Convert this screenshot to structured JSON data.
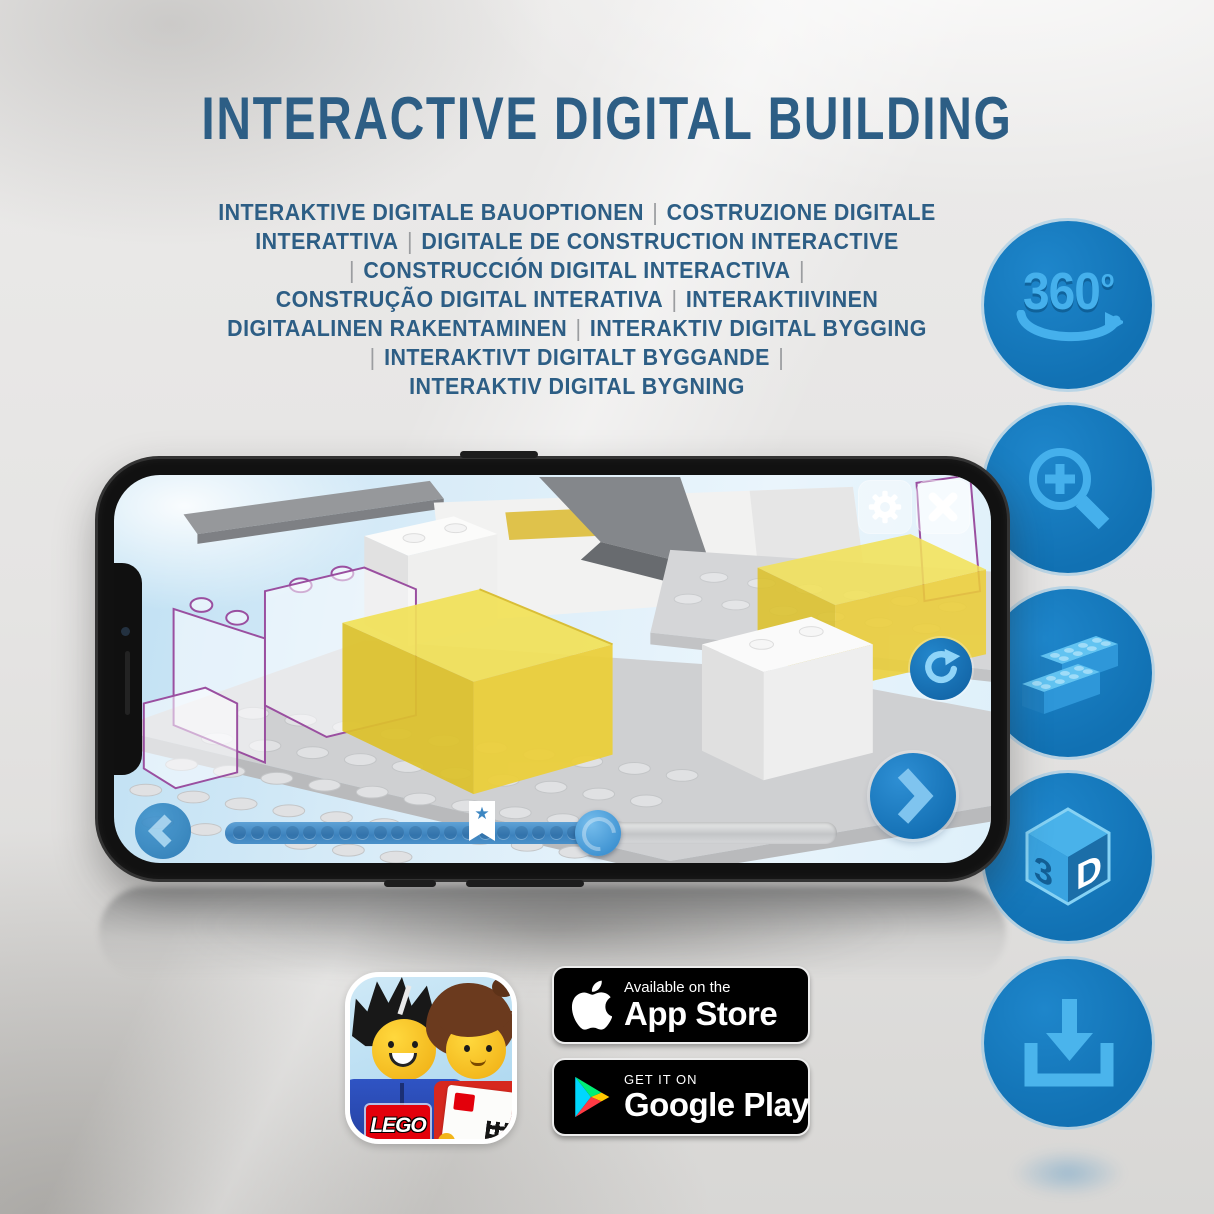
{
  "header": {
    "title": "INTERACTIVE DIGITAL BUILDING"
  },
  "subtitle": {
    "lines": [
      "INTERAKTIVE DIGITALE BAUOPTIONEN | COSTRUZIONE DIGITALE",
      "INTERATTIVA | DIGITALE DE CONSTRUCTION INTERACTIVE",
      "| CONSTRUCCIÓN DIGITAL INTERACTIVA |",
      "CONSTRUÇÃO DIGITAL INTERATIVA | INTERAKTIIVINEN",
      "DIGITAALINEN RAKENTAMINEN | INTERAKTIV DIGITAL BYGGING",
      "| INTERAKTIVT DIGITALT BYGGANDE |",
      "INTERAKTIV DIGITAL BYGNING"
    ]
  },
  "features": {
    "rotate360": {
      "number": "360",
      "degree": "o"
    },
    "cube": {
      "left": "3",
      "right": "D"
    },
    "icon_names": [
      "360-rotation-icon",
      "zoom-in-icon",
      "lego-brick-icon",
      "3d-view-icon",
      "download-icon"
    ]
  },
  "phone_app": {
    "progress": {
      "percent": 61,
      "bookmark_percent": 42,
      "dots": 20,
      "star": "★"
    },
    "icon_names": [
      "settings-gear-icon",
      "close-icon",
      "rotate-icon",
      "previous-arrow-icon",
      "next-arrow-icon"
    ]
  },
  "store": {
    "app_store": {
      "line1": "Available on the",
      "line2": "App Store"
    },
    "google_play": {
      "line1": "GET IT ON",
      "line2": "Google Play"
    }
  },
  "lego_icon": {
    "logo_text": "LEGO"
  },
  "colors": {
    "title_blue": "#2d5e85",
    "circle_blue": "#1577bd",
    "icon_light_blue": "#45b0ec",
    "brick_yellow": "#f0dc4e",
    "badge_black": "#000000"
  }
}
